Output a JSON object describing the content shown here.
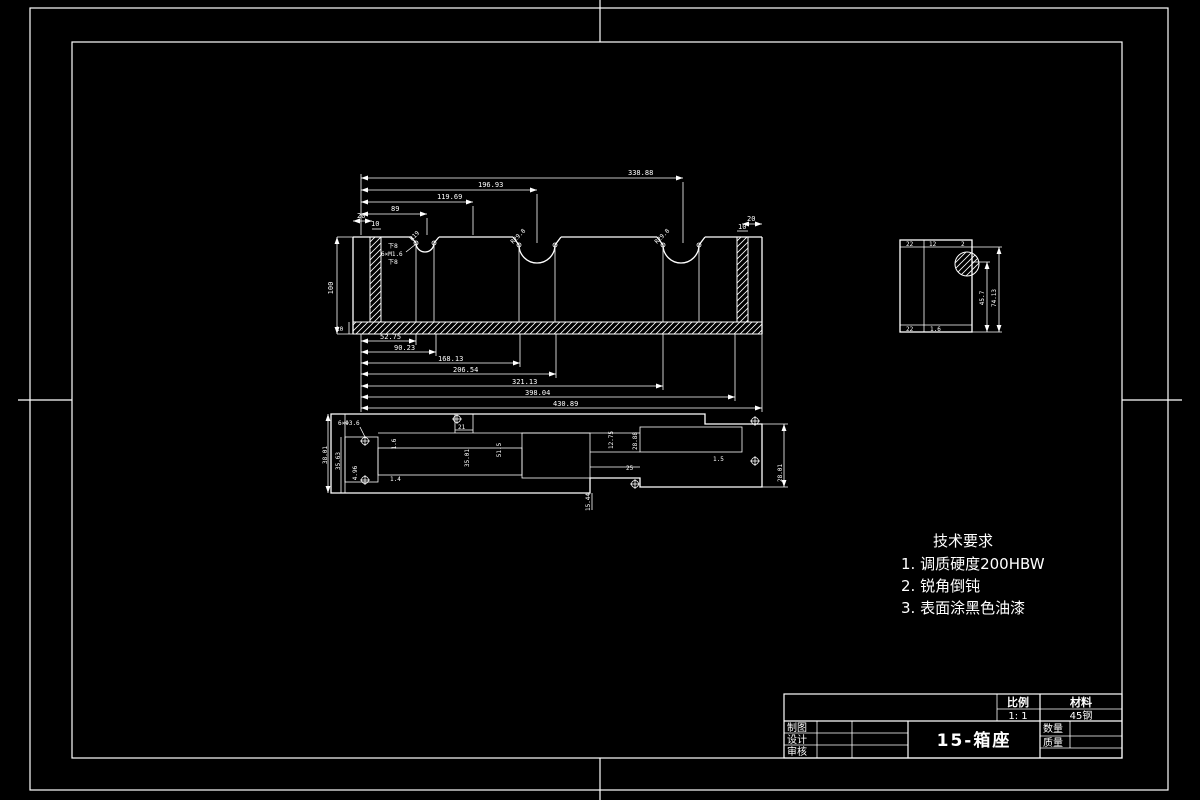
{
  "sheet": {
    "background_color": "#000000",
    "line_color": "#ffffff"
  },
  "front_view": {
    "dim_top_1": "338.88",
    "dim_top_2": "196.93",
    "dim_top_3": "119.69",
    "dim_top_4": "89",
    "dim_top_5": "20",
    "dim_top_6": "10",
    "dim_right_1": "20",
    "dim_right_2": "10",
    "dim_height": "100",
    "dim_base_thickness": "10",
    "dim_bot_1": "52.75",
    "dim_bot_2": "90.23",
    "dim_bot_3": "168.13",
    "dim_bot_4": "206.54",
    "dim_bot_5": "321.13",
    "dim_bot_6": "398.04",
    "dim_bot_7": "430.89",
    "radius_left": "R19",
    "radius_mid": "R29.8",
    "radius_right": "R29.8",
    "note_above": "下8",
    "note_thread": "6×M1.6",
    "note_below": "下8"
  },
  "side_view": {
    "dim_top_1": "22",
    "dim_top_2": "12",
    "dim_top_3": "2",
    "dim_bot_1": "22",
    "dim_bot_2": "1.6",
    "dim_v_inner": "45.7",
    "dim_v_outer": "74.13"
  },
  "plan_view": {
    "note_holes": "6×Φ3.6",
    "dim_38_01": "38.01",
    "dim_35_63": "35.63",
    "dim_4_96": "4.96",
    "dim_1_6": "1.6",
    "dim_21": "21",
    "dim_35_01": "35.01",
    "dim_51_5": "51.5",
    "dim_12_75": "12.75",
    "dim_28_88": "28.88",
    "dim_1_5": "1.5",
    "dim_25": "25",
    "dim_28_01": "28.01",
    "dim_1_4": "1.4",
    "dim_15_44": "15.44"
  },
  "tech_requirements": {
    "title": "技术要求",
    "item_1": "1. 调质硬度200HBW",
    "item_2": "2. 锐角倒钝",
    "item_3": "3. 表面涂黑色油漆"
  },
  "title_block": {
    "part_name": "15-箱座",
    "scale_label": "比例",
    "scale_value": "1: 1",
    "material_label": "材料",
    "material_value": "45钢",
    "qty_label": "数量",
    "mass_label": "质量",
    "row_draft": "制图",
    "row_design": "设计",
    "row_audit": "审核"
  }
}
